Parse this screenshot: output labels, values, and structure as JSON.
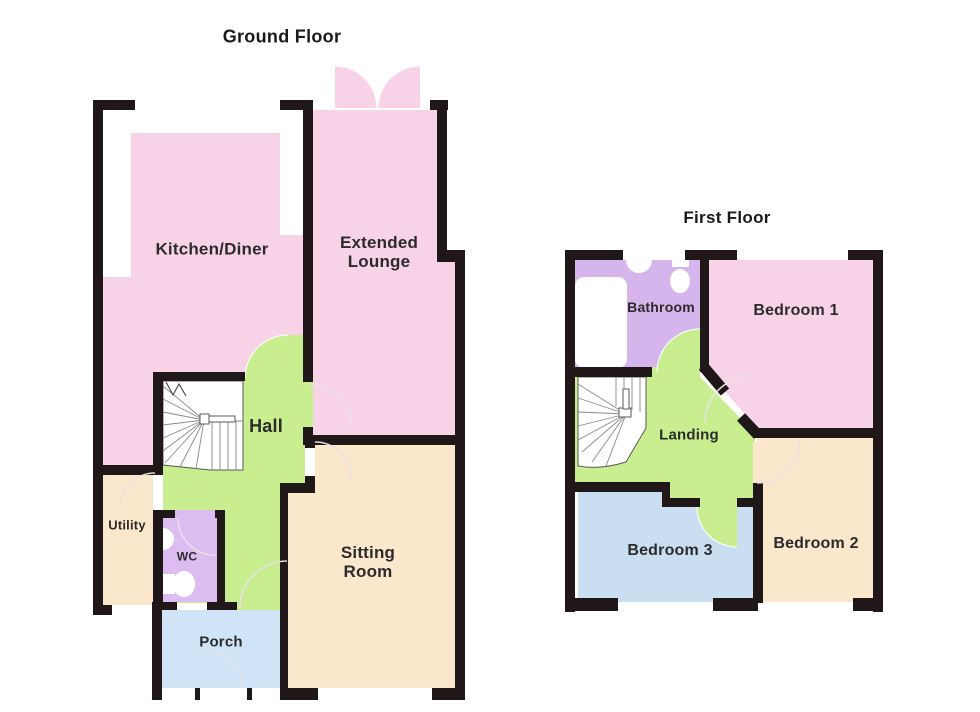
{
  "page": {
    "background": "#ffffff"
  },
  "colors": {
    "wall": "#201718",
    "room_pink": "#f8d3e8",
    "room_green": "#c8ee90",
    "room_tan": "#fbe7cb",
    "room_purple_wc": "#dcbcf1",
    "room_purple_bath": "#d5b5ec",
    "room_blue_porch": "#cfe4f6",
    "room_blue_bed3": "#cadef2",
    "label_text": "#2b2b2b",
    "white": "#ffffff"
  },
  "ground_floor": {
    "title": "Ground Floor",
    "rooms": {
      "kitchen_diner": "Kitchen/Diner",
      "extended_lounge": "Extended\nLounge",
      "hall": "Hall",
      "utility": "Utility",
      "wc": "WC",
      "porch": "Porch",
      "sitting_room": "Sitting\nRoom"
    }
  },
  "first_floor": {
    "title": "First Floor",
    "rooms": {
      "bathroom": "Bathroom",
      "bedroom_1": "Bedroom 1",
      "landing": "Landing",
      "bedroom_3": "Bedroom 3",
      "bedroom_2": "Bedroom 2"
    }
  }
}
